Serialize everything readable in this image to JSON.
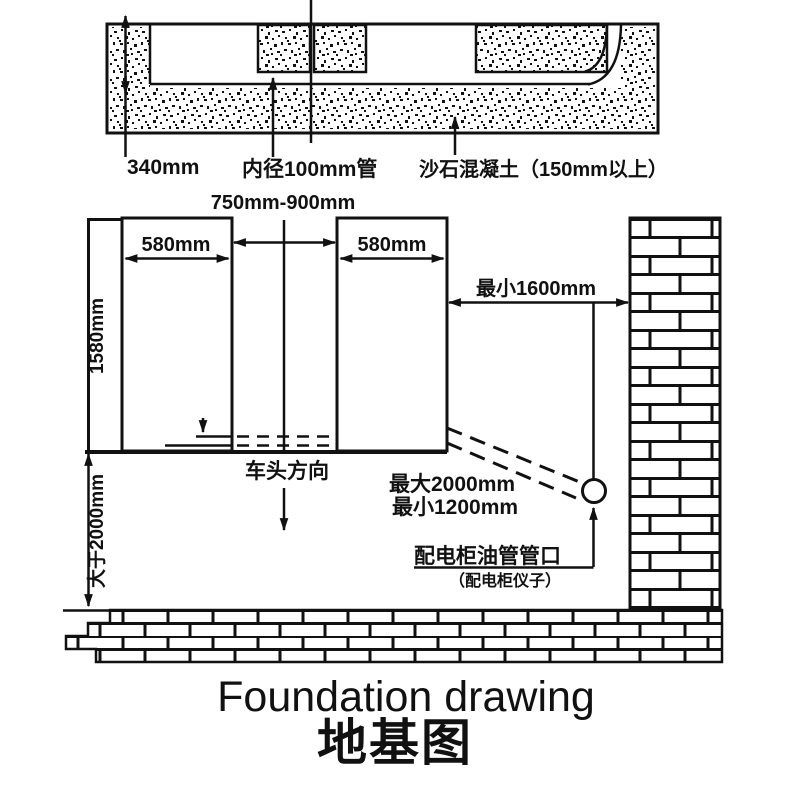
{
  "colors": {
    "ink": "#111111",
    "paper": "#ffffff"
  },
  "cross_section": {
    "dim_340": "340mm",
    "pipe_label": "内径100mm管",
    "concrete_label": "沙石混凝土（150mm以上）"
  },
  "plan": {
    "gap_dim": "750mm-900mm",
    "left_pit_width": "580mm",
    "right_pit_width": "580mm",
    "pit_depth": "1580mm",
    "ground_clearance": "大于2000mm",
    "wall_clearance": "最小1600mm",
    "vehicle_direction": "车头方向",
    "pipe_max": "最大2000mm",
    "pipe_min": "最小1200mm",
    "port_label": "配电柜油管管口",
    "port_note": "（配电柜仪子）"
  },
  "title": {
    "en": "Foundation drawing",
    "zh": "地基图"
  }
}
